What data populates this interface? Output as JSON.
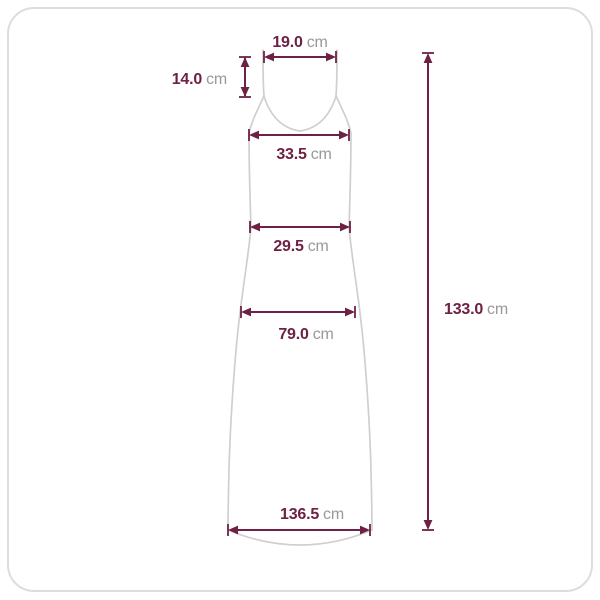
{
  "card": {
    "background": "#ffffff",
    "border_color": "#dddddd"
  },
  "diagram": {
    "name": "dress-flat-measurement-diagram",
    "outline_shape": "sleeveless-slip-dress",
    "unit": "cm",
    "colors": {
      "dimension_line": "#6e2145",
      "value_text": "#6e2145",
      "unit_text": "#999999",
      "garment_outline": "#cfcfcf",
      "card_border": "#dddddd"
    },
    "measurements": {
      "top_width": {
        "value": "19.0",
        "unit": "cm"
      },
      "strap_length": {
        "value": "14.0",
        "unit": "cm"
      },
      "bust_width": {
        "value": "33.5",
        "unit": "cm"
      },
      "waist_width": {
        "value": "29.5",
        "unit": "cm"
      },
      "hip_width": {
        "value": "79.0",
        "unit": "cm"
      },
      "hem_width": {
        "value": "136.5",
        "unit": "cm"
      },
      "total_length": {
        "value": "133.0",
        "unit": "cm"
      }
    }
  }
}
